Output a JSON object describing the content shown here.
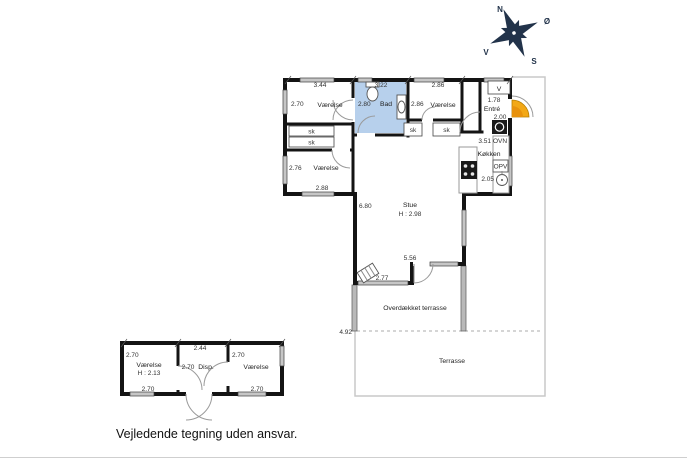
{
  "footer": {
    "disclaimer": "Vejledende tegning uden ansvar."
  },
  "compass": {
    "north": "N",
    "east": "Ø",
    "south": "S",
    "west": "V"
  },
  "main_house": {
    "bedroom_top_left": {
      "label": "Værelse",
      "width": "3.44",
      "depth": "2.70"
    },
    "bathroom": {
      "label": "Bad",
      "width": "3.22",
      "depth": "2.80"
    },
    "bedroom_top_right": {
      "label": "Værelse",
      "width": "2.86",
      "depth": "2.86"
    },
    "entry": {
      "label": "Entré",
      "width": "1.78",
      "depth": "2.00",
      "cabinet": "V"
    },
    "kitchen": {
      "label": "Køkken",
      "depth": "3.51",
      "width": "2.05",
      "oven": "OVN",
      "dishwasher": "OPV"
    },
    "bedroom_bottom_left": {
      "label": "Værelse",
      "depth": "2.76",
      "width": "2.88"
    },
    "living_room": {
      "label": "Stue",
      "ceiling": "H : 2.98",
      "wall_left": "6.80",
      "wall_step": "5.56",
      "window": "2.77"
    },
    "closet": "sk"
  },
  "terrace": {
    "covered": "Overdækket terrasse",
    "open": "Terrasse",
    "width": "4.92"
  },
  "annex": {
    "bedroom_left": {
      "label": "Værelse",
      "ceiling": "H : 2.13",
      "side": "2.70",
      "bottom": "2.70"
    },
    "storage": {
      "label": "Disp.",
      "top": "2.44",
      "side": "2.70"
    },
    "bedroom_right": {
      "label": "Værelse",
      "side": "2.70",
      "bottom": "2.70"
    }
  },
  "colors": {
    "bathroom_fill": "#b7d0ec",
    "door_highlight": "#f3a816",
    "wall": "#141414",
    "window_fill": "#c6c6c6",
    "terrace_line": "#c9c9c9"
  }
}
